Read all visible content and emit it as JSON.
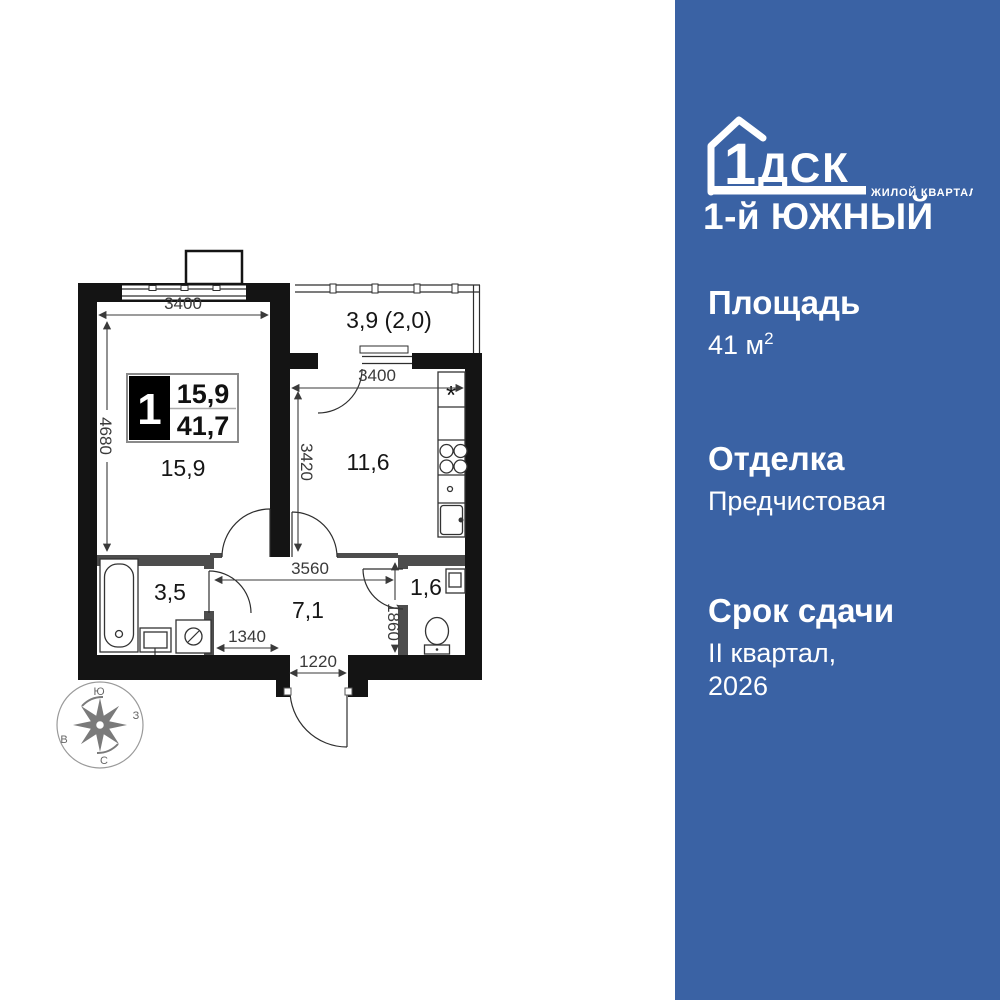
{
  "colors": {
    "sidebar_blue": "#3A62A4",
    "wall_black": "#141414",
    "wall_gray": "#4D4D4D",
    "dimension_gray": "#3A3A3A"
  },
  "sidebar": {
    "logo": {
      "number": "1",
      "brand": "ДСК",
      "tagline": "ЖИЛОЙ КВАРТАЛ",
      "project": "1-й ЮЖНЫЙ"
    },
    "area": {
      "label": "Площадь",
      "value": "41 м",
      "sup": "2"
    },
    "finishing": {
      "label": "Отделка",
      "value": "Предчистовая"
    },
    "deadline": {
      "label": "Срок сдачи",
      "line1": "II квартал,",
      "line2": "2026"
    }
  },
  "plan": {
    "badge": {
      "rooms": "1",
      "living_area": "15,9",
      "total_area": "41,7"
    },
    "rooms": {
      "living": "15,9",
      "balcony": "3,9 (2,0)",
      "kitchen": "11,6",
      "bathroom": "3,5",
      "hallway": "7,1",
      "wc": "1,6"
    },
    "dimensions": {
      "living_width": "3400",
      "living_height": "4680",
      "kitchen_width": "3400",
      "kitchen_height": "3420",
      "hallway_width": "3560",
      "bath_width": "1340",
      "entrance_width": "1220",
      "wc_height": "1860"
    },
    "compass": {
      "top": "Ю",
      "right": "З",
      "bottom": "С",
      "left": "В"
    },
    "symbols": {
      "kitchen_unit": "*"
    }
  }
}
